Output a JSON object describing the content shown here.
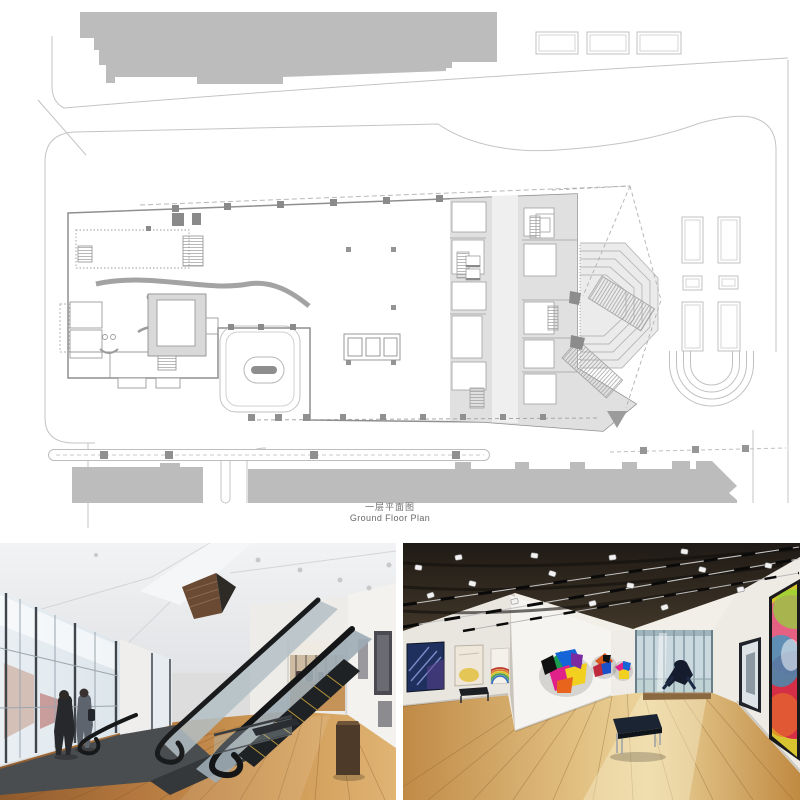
{
  "plan": {
    "caption_zh": "一层平面图",
    "caption_en": "Ground Floor Plan",
    "colors": {
      "context_building": "#bcbcbc",
      "building_zone_fill": "#e0e0e0",
      "wall_line": "#8f8f8f",
      "site_line": "#c4c4c4",
      "pier_dark": "#8a8a8a",
      "caption_text": "#6a6a6a"
    }
  },
  "photos": {
    "left": {
      "name": "escalator-hall-photo",
      "floor_color": "#b5793f"
    },
    "right": {
      "name": "gallery-photo",
      "ceiling_color": "#2a241d",
      "artwork_accents": [
        "#1f2f5e",
        "#e0218a",
        "#f2d01f",
        "#1565d8",
        "#1b9e50",
        "#d41f4a"
      ]
    }
  }
}
